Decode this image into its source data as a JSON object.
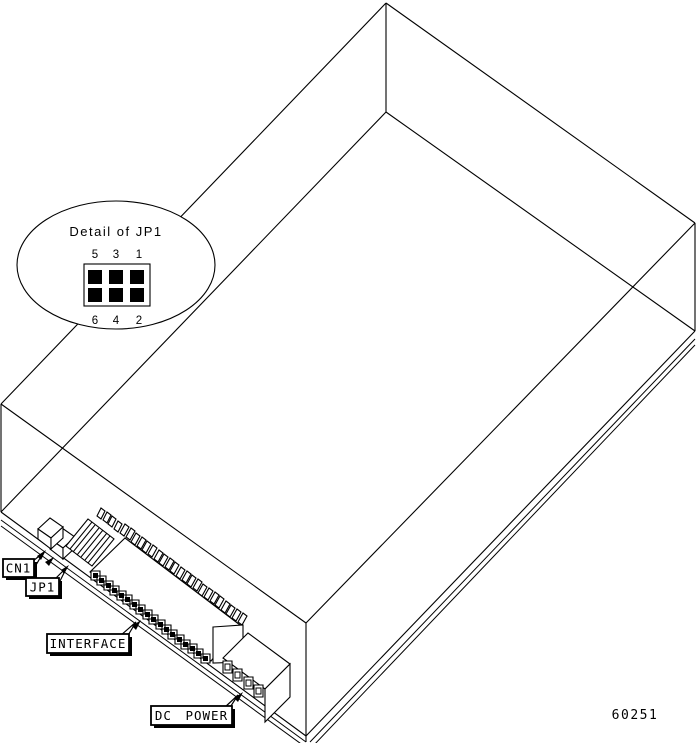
{
  "figure": {
    "callout": {
      "title": "Detail of JP1",
      "pin_numbers_top": [
        "5",
        "3",
        "1"
      ],
      "pin_numbers_bottom": [
        "6",
        "4",
        "2"
      ]
    },
    "labels": {
      "cn1": "CN1",
      "jp1": "JP1",
      "interface": "INTERFACE",
      "dc_power": "DC POWER"
    },
    "figure_number": "60251",
    "colors": {
      "line": "#000000",
      "background": "#ffffff"
    }
  }
}
